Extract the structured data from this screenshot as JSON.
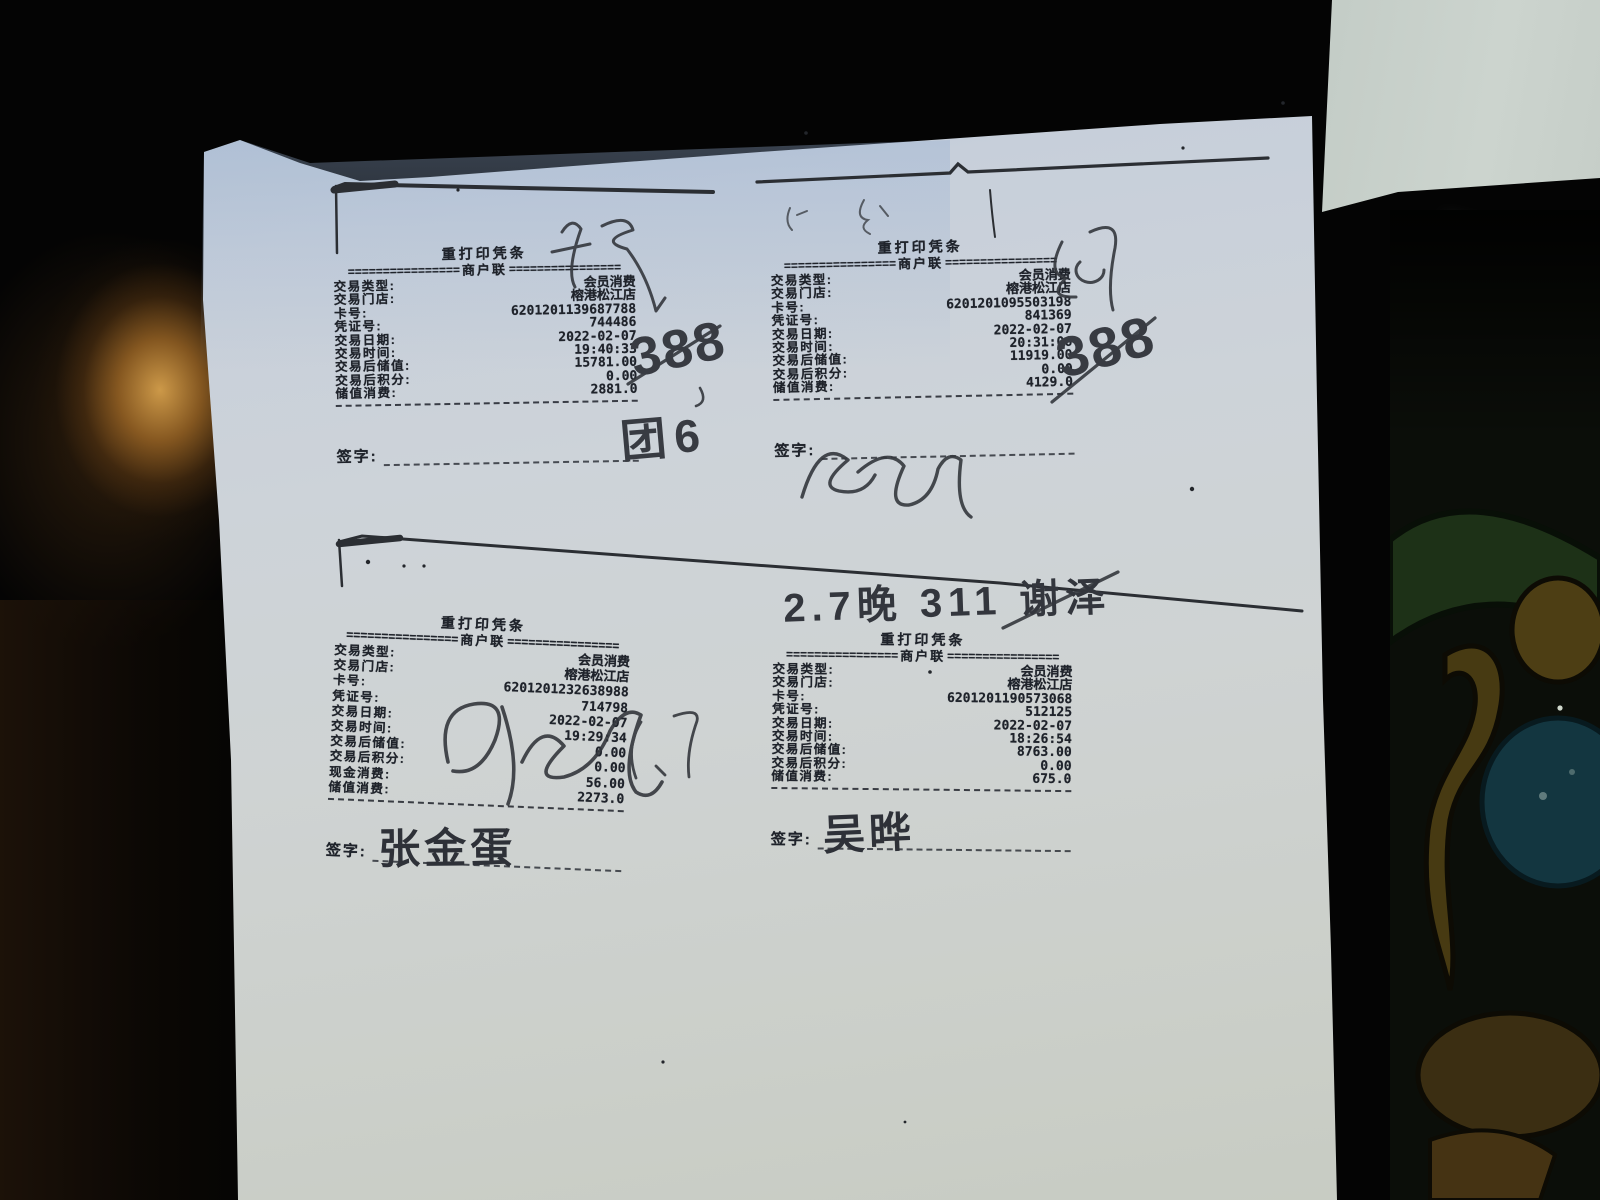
{
  "print": {
    "sep_fill": "================"
  },
  "receipts": [
    {
      "position": "top-left",
      "title": "重打印凭条",
      "copy_label": "商户联",
      "rows": [
        {
          "label": "交易类型:",
          "value": "会员消费"
        },
        {
          "label": "交易门店:",
          "value": "榕港松江店"
        },
        {
          "label": "卡号:",
          "value": "6201201139687788"
        },
        {
          "label": "凭证号:",
          "value": "744486"
        },
        {
          "label": "交易日期:",
          "value": "2022-02-07"
        },
        {
          "label": "交易时间:",
          "value": "19:40:33"
        },
        {
          "label": "交易后储值:",
          "value": "15781.00"
        },
        {
          "label": "交易后积分:",
          "value": "0.00"
        },
        {
          "label": "储值消费:",
          "value": "2881.0"
        }
      ],
      "sign_label": "签字:",
      "signature": ""
    },
    {
      "position": "top-right",
      "title": "重打印凭条",
      "copy_label": "商户联",
      "rows": [
        {
          "label": "交易类型:",
          "value": "会员消费"
        },
        {
          "label": "交易门店:",
          "value": "榕港松江店"
        },
        {
          "label": "卡号:",
          "value": "6201201095503198"
        },
        {
          "label": "凭证号:",
          "value": "841369"
        },
        {
          "label": "交易日期:",
          "value": "2022-02-07"
        },
        {
          "label": "交易时间:",
          "value": "20:31:06"
        },
        {
          "label": "交易后储值:",
          "value": "11919.00"
        },
        {
          "label": "交易后积分:",
          "value": "0.00"
        },
        {
          "label": "储值消费:",
          "value": "4129.0"
        }
      ],
      "sign_label": "签字:",
      "signature": ""
    },
    {
      "position": "bottom-left",
      "title": "重打印凭条",
      "copy_label": "商户联",
      "rows": [
        {
          "label": "交易类型:",
          "value": "会员消费"
        },
        {
          "label": "交易门店:",
          "value": "榕港松江店"
        },
        {
          "label": "卡号:",
          "value": "6201201232638988"
        },
        {
          "label": "凭证号:",
          "value": "714798"
        },
        {
          "label": "交易日期:",
          "value": "2022-02-07"
        },
        {
          "label": "交易时间:",
          "value": "19:29:34"
        },
        {
          "label": "交易后储值:",
          "value": "0.00"
        },
        {
          "label": "交易后积分:",
          "value": "0.00"
        },
        {
          "label": "现金消费:",
          "value": "56.00"
        },
        {
          "label": "储值消费:",
          "value": "2273.0"
        }
      ],
      "sign_label": "签字:",
      "signature": "张金蛋"
    },
    {
      "position": "bottom-right",
      "title": "重打印凭条",
      "copy_label": "商户联",
      "rows": [
        {
          "label": "交易类型:",
          "value": "会员消费"
        },
        {
          "label": "交易门店:",
          "value": "榕港松江店"
        },
        {
          "label": "卡号:",
          "value": "6201201190573068"
        },
        {
          "label": "凭证号:",
          "value": "512125"
        },
        {
          "label": "交易日期:",
          "value": "2022-02-07"
        },
        {
          "label": "交易时间:",
          "value": "18:26:54"
        },
        {
          "label": "交易后储值:",
          "value": "8763.00"
        },
        {
          "label": "交易后积分:",
          "value": "0.00"
        },
        {
          "label": "储值消费:",
          "value": "675.0"
        }
      ],
      "sign_label": "签字:",
      "signature": "吴晔"
    }
  ],
  "annotations": {
    "crossed_number_left": "388",
    "table_note_left": "团6",
    "crossed_number_right": "388",
    "evening_note": "2.7晚 311 谢泽"
  },
  "colors": {
    "paper": "#cdd3d9",
    "paper_sheen": "#aab9cd",
    "ink_print": "#1f232b",
    "ink_pen": "#34373d",
    "wood_glow": "#d6a04c",
    "background": "#040404"
  }
}
